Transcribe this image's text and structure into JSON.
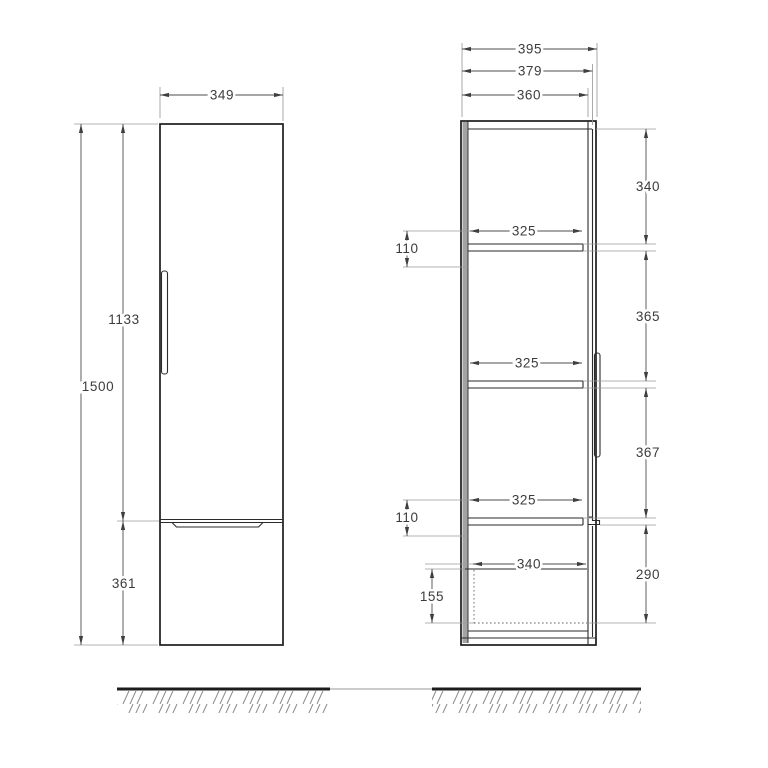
{
  "drawing": {
    "type": "furniture-dimension-drawing",
    "front": {
      "width": "349",
      "total_height": "1500",
      "door_height": "1133",
      "drawer_height": "361"
    },
    "side": {
      "overall_depth": "395",
      "door_depth": "379",
      "carcass_depth": "360",
      "shelf_clear_widths": [
        "325",
        "325",
        "325"
      ],
      "rail_offsets": [
        "110",
        "110"
      ],
      "drawer_width": "340",
      "drawer_inner_height": "155",
      "right_chain": [
        "340",
        "365",
        "367",
        "290"
      ]
    },
    "colors": {
      "outline": "#1d1d1d",
      "dimension_line": "#4d4d4d",
      "extension_line": "#9a9a9a",
      "text": "#3c3c3c",
      "back_panel": "#a3a3a3",
      "hatch": "#8a8a8a"
    }
  }
}
